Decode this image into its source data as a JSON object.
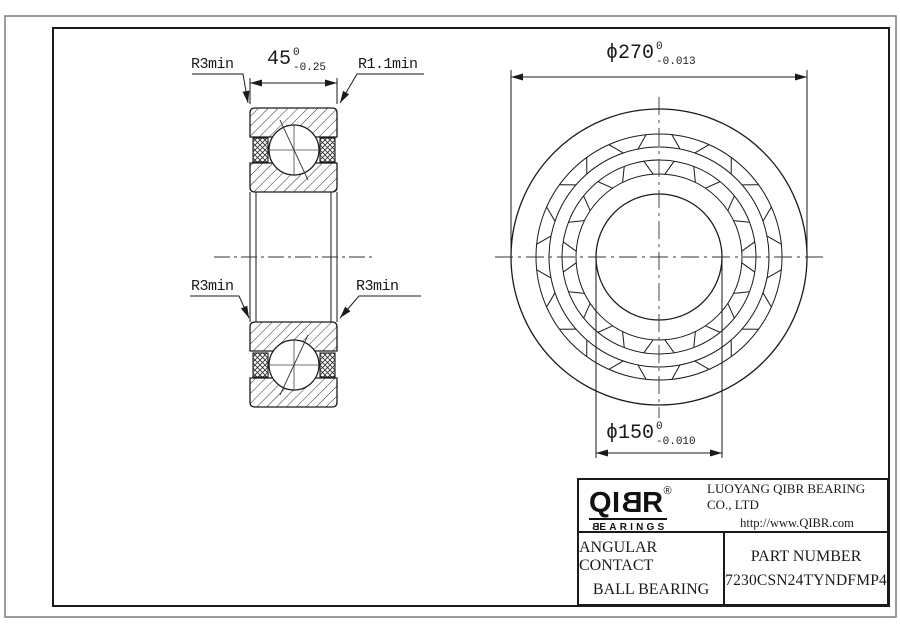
{
  "drawing": {
    "labels": {
      "r3min_top_left": "R3min",
      "r1_1min_top_right": "R1.1min",
      "r3min_mid_left": "R3min",
      "r3min_mid_right": "R3min"
    },
    "dimensions": {
      "width": {
        "value": "45",
        "tol_top": "0",
        "tol_bottom": "-0.25"
      },
      "outer_diameter": {
        "value": "ϕ270",
        "tol_top": "0",
        "tol_bottom": "-0.013"
      },
      "bore_diameter": {
        "value": "ϕ150",
        "tol_top": "0",
        "tol_bottom": "-0.010"
      }
    }
  },
  "title_block": {
    "logo": {
      "p1": "QI",
      "p2": "B",
      "p3": "R",
      "reg": "®",
      "sub_b": "B",
      "sub_rest": "EARINGS"
    },
    "company": "LUOYANG QIBR BEARING CO., LTD",
    "website": "http://www.QIBR.com",
    "product_line1": "ANGULAR CONTACT",
    "product_line2": "BALL BEARING",
    "part_number_label": "PART NUMBER",
    "part_number": "7230CSN24TYNDFMP4"
  },
  "colors": {
    "line": "#1a1a1a",
    "background": "#ffffff"
  }
}
